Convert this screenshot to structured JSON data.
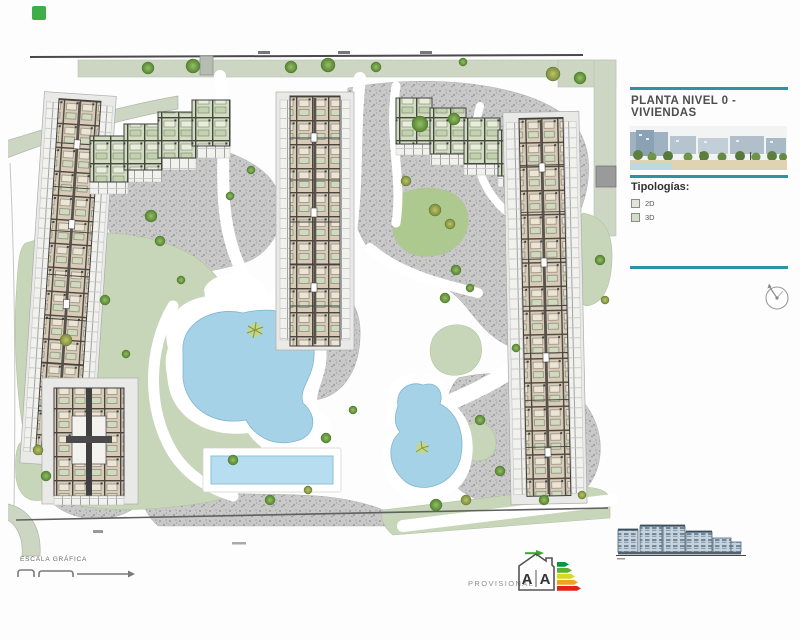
{
  "title_block": {
    "title": "PLANTA NIVEL 0 - VIVIENDAS",
    "legend": {
      "heading": "Tipologías:",
      "items": [
        {
          "label": "2D",
          "swatch_color": "#dfe3d8"
        },
        {
          "label": "3D",
          "swatch_color": "#cfe0c6"
        }
      ]
    }
  },
  "footer": {
    "scale_label": "ESCALA GRÁFICA",
    "watermark": "PROVISIONAL",
    "energy_rating": {
      "letters": [
        "A",
        "A"
      ]
    }
  },
  "icons": {
    "compass": "north-compass-dial",
    "energy_house": "energy-certificate-house",
    "rendering": "project-rendering-thumbnail",
    "elevation": "building-elevation-drawing",
    "scalebar": "graphic-scale-bar"
  },
  "colors": {
    "accent_teal": "#2d93a3",
    "pool_blue": "#a5d2e6",
    "lap_pool_blue": "#b7def0",
    "lawn_green": "#c7d5b9",
    "bright_lawn": "#aec98f",
    "road_sage": "#ccd6c3",
    "paving_gray": "#c9c9c9",
    "building_tan": "#d8ccb8",
    "building_wall": "#3f3f3f",
    "tree_green": "#6fa046",
    "tree_olive": "#a4ad55",
    "marker_green": "#3fae49"
  }
}
